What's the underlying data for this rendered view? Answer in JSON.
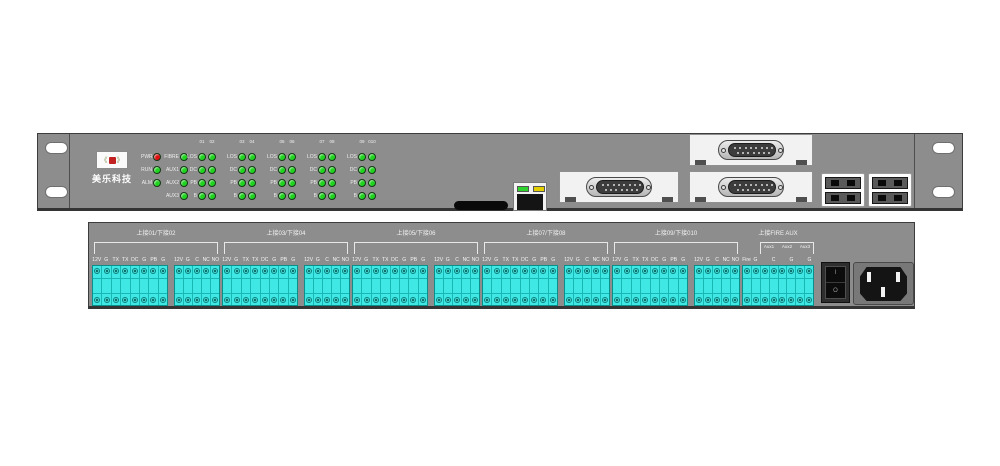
{
  "front_panel": {
    "logo": {
      "wreath_left": "《",
      "wreath_right": "》",
      "text": "美乐科技"
    },
    "led_matrix": {
      "channel_headers": [
        "01",
        "02",
        "03",
        "04",
        "05",
        "06",
        "07",
        "08",
        "09",
        "010"
      ],
      "channel_groups": 5,
      "channel_led_color": "#1fd41f",
      "rows": [
        {
          "status_label": "PWR",
          "status_color": "#e01010",
          "aux_label": "FIBRE",
          "aux_color": "#1fd41f",
          "channel_label": "LOS"
        },
        {
          "status_label": "RUN",
          "status_color": "#1fd41f",
          "aux_label": "AUX1",
          "aux_color": "#1fd41f",
          "channel_label": "DC"
        },
        {
          "status_label": "ALM",
          "status_color": "#1fd41f",
          "aux_label": "AUX2",
          "aux_color": "#1fd41f",
          "channel_label": "PB"
        },
        {
          "status_label": "",
          "status_color": "",
          "aux_label": "AUX3",
          "aux_color": "#1fd41f",
          "channel_label": "B"
        }
      ]
    },
    "ethernet": {
      "led_left_color": "#2ed32e",
      "led_right_color": "#e3cf00"
    },
    "db15_module_count": 3,
    "fiber_adapter_count": 2
  },
  "rear_panel": {
    "groups": [
      {
        "header": "上接01/下接02",
        "main_labels": [
          "12V",
          "G",
          "TX",
          "TX",
          "DC",
          "G",
          "PB",
          "G"
        ],
        "relay_labels": [
          "12V",
          "G",
          "C",
          "NC",
          "NO"
        ]
      },
      {
        "header": "上接03/下接04",
        "main_labels": [
          "12V",
          "G",
          "TX",
          "TX",
          "DC",
          "G",
          "PB",
          "G"
        ],
        "relay_labels": [
          "12V",
          "G",
          "C",
          "NC",
          "NO"
        ]
      },
      {
        "header": "上接05/下接06",
        "main_labels": [
          "12V",
          "G",
          "TX",
          "TX",
          "DC",
          "G",
          "PB",
          "G"
        ],
        "relay_labels": [
          "12V",
          "G",
          "C",
          "NC",
          "NO"
        ]
      },
      {
        "header": "上接07/下接08",
        "main_labels": [
          "12V",
          "G",
          "TX",
          "TX",
          "DC",
          "G",
          "PB",
          "G"
        ],
        "relay_labels": [
          "12V",
          "G",
          "C",
          "NC",
          "NO"
        ]
      },
      {
        "header": "上接09/下接010",
        "main_labels": [
          "12V",
          "G",
          "TX",
          "TX",
          "DC",
          "G",
          "PB",
          "G"
        ],
        "relay_labels": [
          "12V",
          "G",
          "C",
          "NC",
          "NO"
        ]
      },
      {
        "header": "上接FIRE AUX",
        "main_labels": [
          "Fire",
          "G",
          "",
          "C",
          "",
          "G",
          "",
          "G"
        ],
        "aux_bracket_labels": [
          "Aux1",
          "Aux2",
          "Aux3"
        ]
      }
    ],
    "power_switch": {
      "on_label": "I",
      "off_label": "O"
    }
  },
  "colors": {
    "panel": "#8d8d8d",
    "panel_border": "#3c3c3c",
    "terminal": "#3fe8e4",
    "terminal_border": "#0b8f8b",
    "led_green": "#1fd41f",
    "led_red": "#e01010",
    "label_text": "#f2f2f2"
  }
}
